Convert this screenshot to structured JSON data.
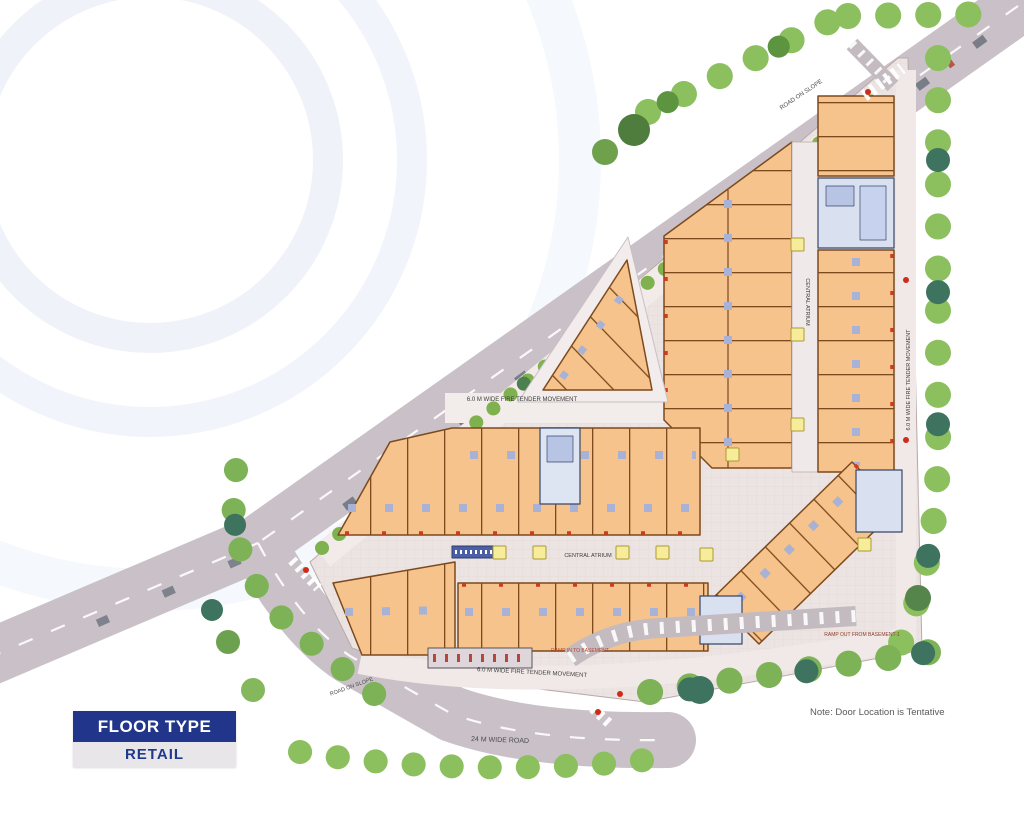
{
  "legend": {
    "title": "FLOOR TYPE",
    "value": "RETAIL"
  },
  "note": "Note:  Door Location is Tentative",
  "plan_labels": {
    "road_main": "24 M WIDE ROAD",
    "road_slope_top": "ROAD ON SLOPE",
    "road_slope_corner": "ROAD ON SLOPE",
    "fire_lane_top": "6.0 M WIDE FIRE TENDER MOVEMENT",
    "fire_lane_bottom": "6.0 M WIDE FIRE TENDER MOVEMENT",
    "fire_lane_right": "6.0 M WIDE FIRE TENDER MOVEMENT",
    "atrium_right": "CENTRAL ATRIUM",
    "atrium_bottom": "CENTRAL ATRIUM",
    "ramp_in": "RAMP IN TO BASEMENT",
    "ramp_out": "RAMP OUT FROM BASEMENT-1"
  },
  "colors": {
    "legend_navy": "#21368b",
    "retail_unit_fill": "#f5c38b",
    "retail_unit_outline": "#7c4a1d",
    "road_gray": "#c9c1c7",
    "plaza": "#ece4e2",
    "tree_green": "#6fae49",
    "kiosk_yellow": "#f7ec9a",
    "service_core_blue": "#d9e0f0"
  }
}
